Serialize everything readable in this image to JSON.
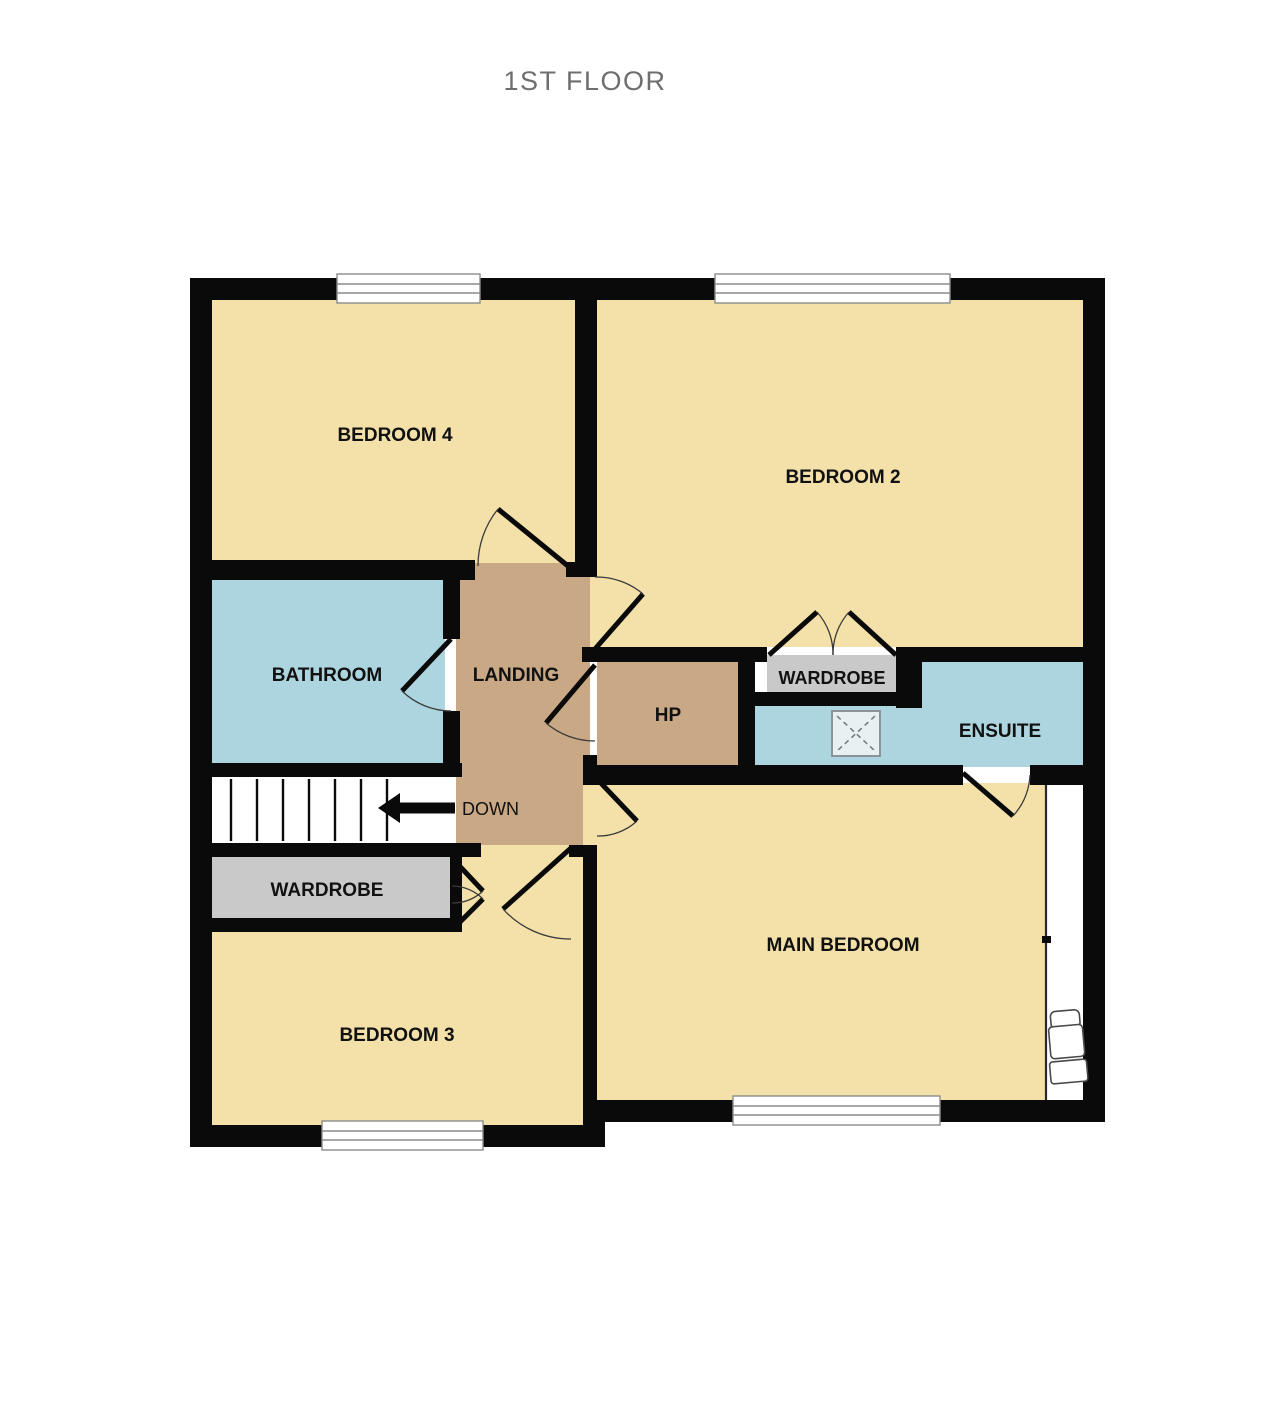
{
  "page": {
    "title": "1ST FLOOR"
  },
  "rooms": {
    "bedroom4": "BEDROOM 4",
    "bedroom2": "BEDROOM 2",
    "bathroom": "BATHROOM",
    "landing": "LANDING",
    "hp": "HP",
    "wardrobe_top": "WARDROBE",
    "ensuite": "ENSUITE",
    "wardrobe_left": "WARDROBE",
    "bedroom3": "BEDROOM 3",
    "main_bedroom": "MAIN BEDROOM"
  },
  "stairs": {
    "direction": "DOWN"
  },
  "icons": {
    "stairs_arrow": "left-arrow-icon",
    "shower": "shower-tray-icon",
    "armchair": "armchair-icon"
  },
  "colors": {
    "room_fill": "#F3E1A9",
    "circulation_fill": "#C9A886",
    "wet_room_fill": "#ADD5DF",
    "wardrobe_fill": "#C9C9C9",
    "wall": "#0A0A0A",
    "title_text": "#6E6E6E",
    "label_text": "#111111"
  }
}
